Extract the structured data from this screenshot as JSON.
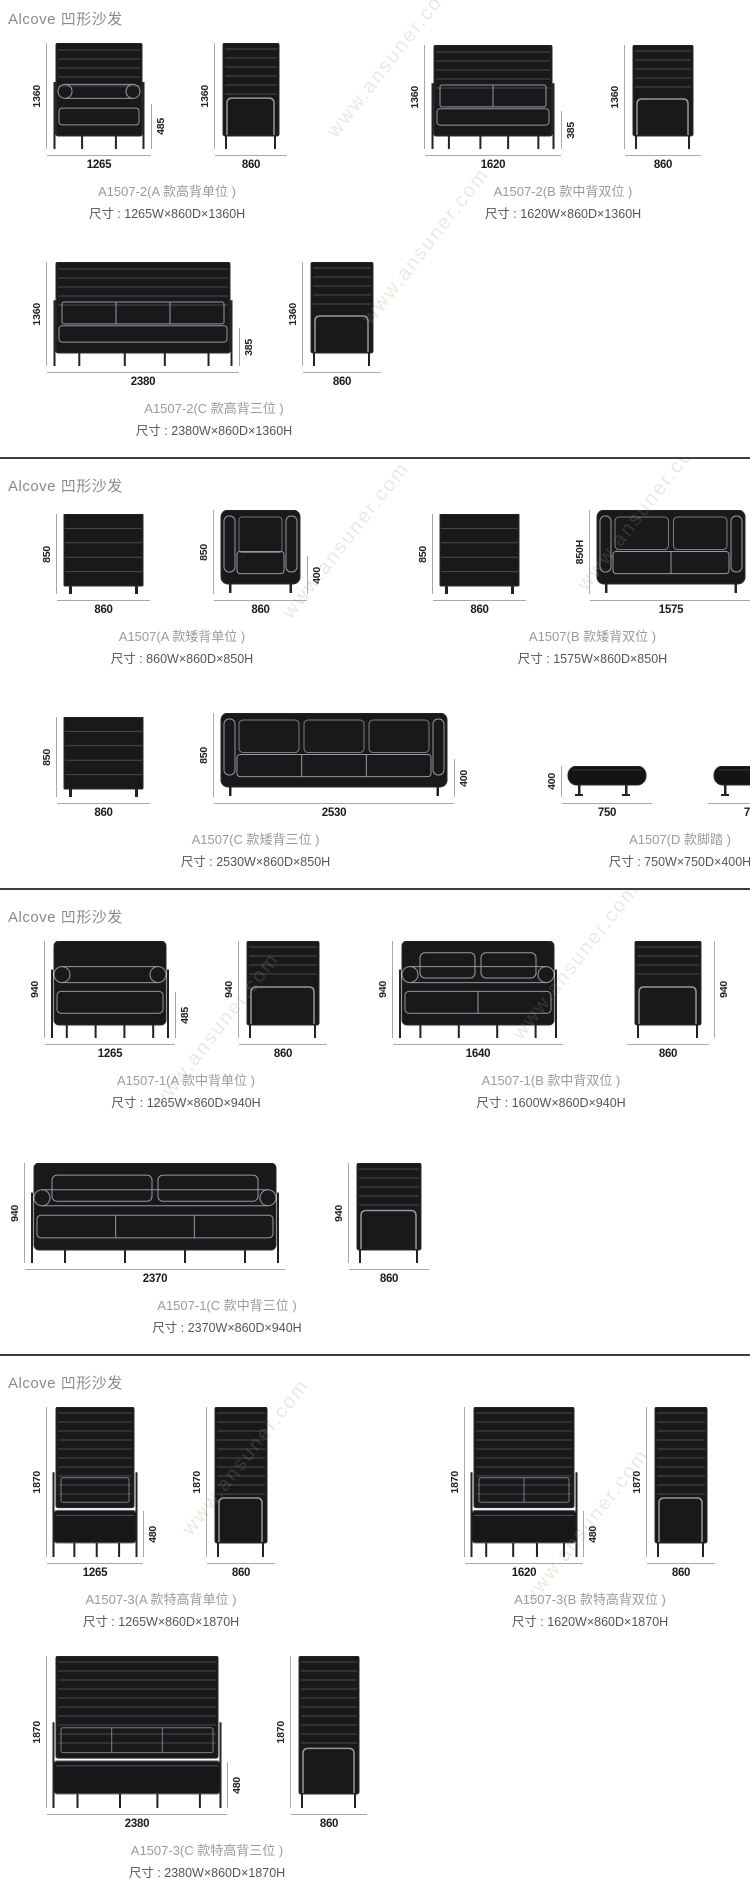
{
  "watermark": "www.ansuner.com",
  "sections": [
    {
      "header": "Alcove 凹形沙发",
      "rows": [
        {
          "items": [
            {
              "name": "A1507-2(A 款高背单位 )",
              "size": "尺寸 : 1265W×860D×1360H",
              "views": [
                {
                  "height": "1360",
                  "width": "1265",
                  "inner": "485"
                },
                {
                  "height": "1360",
                  "width": "860"
                }
              ]
            },
            {
              "name": "A1507-2(B 款中背双位 )",
              "size": "尺寸 : 1620W×860D×1360H",
              "views": [
                {
                  "height": "1360",
                  "width": "1620",
                  "inner": "385"
                },
                {
                  "height": "1360",
                  "width": "860"
                }
              ]
            }
          ]
        },
        {
          "items": [
            {
              "name": "A1507-2(C 款高背三位 )",
              "size": "尺寸 : 2380W×860D×1360H",
              "views": [
                {
                  "height": "1360",
                  "width": "2380",
                  "inner": "385"
                },
                {
                  "height": "1360",
                  "width": "860"
                }
              ]
            }
          ]
        }
      ]
    },
    {
      "header": "Alcove 凹形沙发",
      "rows": [
        {
          "items": [
            {
              "name": "A1507(A 款矮背单位 )",
              "size": "尺寸 : 860W×860D×850H",
              "views": [
                {
                  "height": "850",
                  "width": "860"
                },
                {
                  "height": "850",
                  "width": "860",
                  "inner": "400"
                }
              ]
            },
            {
              "name": "A1507(B 款矮背双位 )",
              "size": "尺寸 : 1575W×860D×850H",
              "views": [
                {
                  "height": "850",
                  "width": "860"
                },
                {
                  "height": "850H",
                  "width": "1575",
                  "inner": "400"
                }
              ]
            }
          ]
        },
        {
          "items": [
            {
              "name": "A1507(C 款矮背三位 )",
              "size": "尺寸 : 2530W×860D×850H",
              "views": [
                {
                  "height": "850",
                  "width": "860"
                },
                {
                  "height": "850",
                  "width": "2530",
                  "inner": "400"
                }
              ]
            },
            {
              "name": "A1507(D 款脚踏 )",
              "size": "尺寸 : 750W×750D×400H",
              "views": [
                {
                  "height": "400",
                  "width": "750"
                },
                {
                  "width": "750"
                }
              ]
            }
          ]
        }
      ]
    },
    {
      "header": "Alcove 凹形沙发",
      "rows": [
        {
          "items": [
            {
              "name": "A1507-1(A 款中背单位 )",
              "size": "尺寸 : 1265W×860D×940H",
              "views": [
                {
                  "height": "940",
                  "width": "1265",
                  "inner": "485"
                },
                {
                  "height": "940",
                  "width": "860"
                }
              ]
            },
            {
              "name": "A1507-1(B 款中背双位 )",
              "size": "尺寸 : 1600W×860D×940H",
              "views": [
                {
                  "height": "940",
                  "width": "1640"
                },
                {
                  "height": "940",
                  "width": "860"
                }
              ]
            }
          ]
        },
        {
          "items": [
            {
              "name": "A1507-1(C 款中背三位 )",
              "size": "尺寸 : 2370W×860D×940H",
              "views": [
                {
                  "height": "940",
                  "width": "2370"
                },
                {
                  "height": "940",
                  "width": "860"
                }
              ]
            }
          ]
        }
      ]
    },
    {
      "header": "Alcove 凹形沙发",
      "rows": [
        {
          "items": [
            {
              "name": "A1507-3(A 款特高背单位 )",
              "size": "尺寸 : 1265W×860D×1870H",
              "views": [
                {
                  "height": "1870",
                  "width": "1265",
                  "inner": "480"
                },
                {
                  "height": "1870",
                  "width": "860"
                }
              ]
            },
            {
              "name": "A1507-3(B 款特高背双位 )",
              "size": "尺寸 : 1620W×860D×1870H",
              "views": [
                {
                  "height": "1870",
                  "width": "1620",
                  "inner": "480"
                },
                {
                  "height": "1870",
                  "width": "860"
                }
              ]
            }
          ]
        },
        {
          "items": [
            {
              "name": "A1507-3(C 款特高背三位 )",
              "size": "尺寸 : 2380W×860D×1870H",
              "views": [
                {
                  "height": "1870",
                  "width": "2380",
                  "inner": "480"
                },
                {
                  "height": "1870",
                  "width": "860"
                }
              ]
            }
          ]
        }
      ]
    }
  ]
}
